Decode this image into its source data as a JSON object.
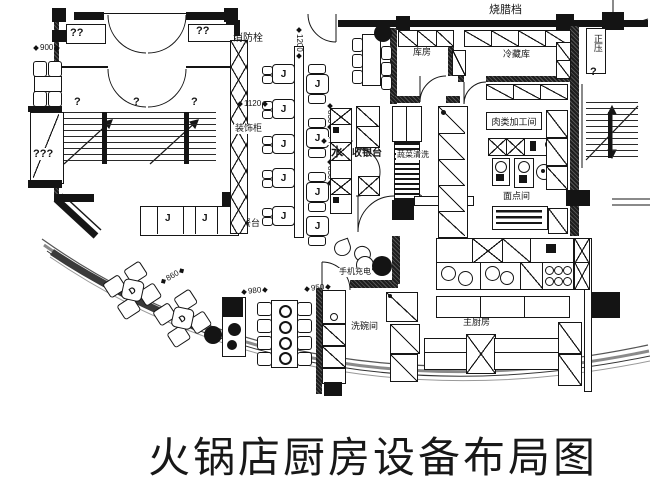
{
  "title": "火锅店厨房设备布局图",
  "rooms": {
    "bbq_stall": "烧腊档",
    "positive_pressure": "正压",
    "storeroom": "库房",
    "cold_storage": "冷藏库",
    "meat_processing": "肉类加工间",
    "pastry_room": "面点间",
    "main_kitchen": "主厨房",
    "dishwash_room": "洗碗间",
    "veg_wash": "蔬菜清洗",
    "cashier": "收银台",
    "water_bar": "水",
    "fire_hydrant": "消防栓",
    "decor_cabinet": "装饰柜",
    "prep_counter": "备餐台",
    "phone_charging": "手机充电"
  },
  "placeholders": {
    "double_q_left": "??",
    "double_q_right": "??",
    "triple_q": "???",
    "stair_q1": "?",
    "stair_q2": "?",
    "stair_q3": "?",
    "right_stair_q": "?"
  },
  "dimensions": {
    "d900": "900",
    "d1200": "1200",
    "d1120": "1120",
    "d830_top": "830",
    "d1250": "1250",
    "d830_bottom": "830",
    "d860": "860",
    "d980": "980",
    "d950": "950"
  },
  "seats": {
    "booth_label": "J",
    "square_label": "D"
  },
  "colors": {
    "ink": "#161616",
    "wall": "#141414",
    "glass_band": "#8a8a8a"
  }
}
